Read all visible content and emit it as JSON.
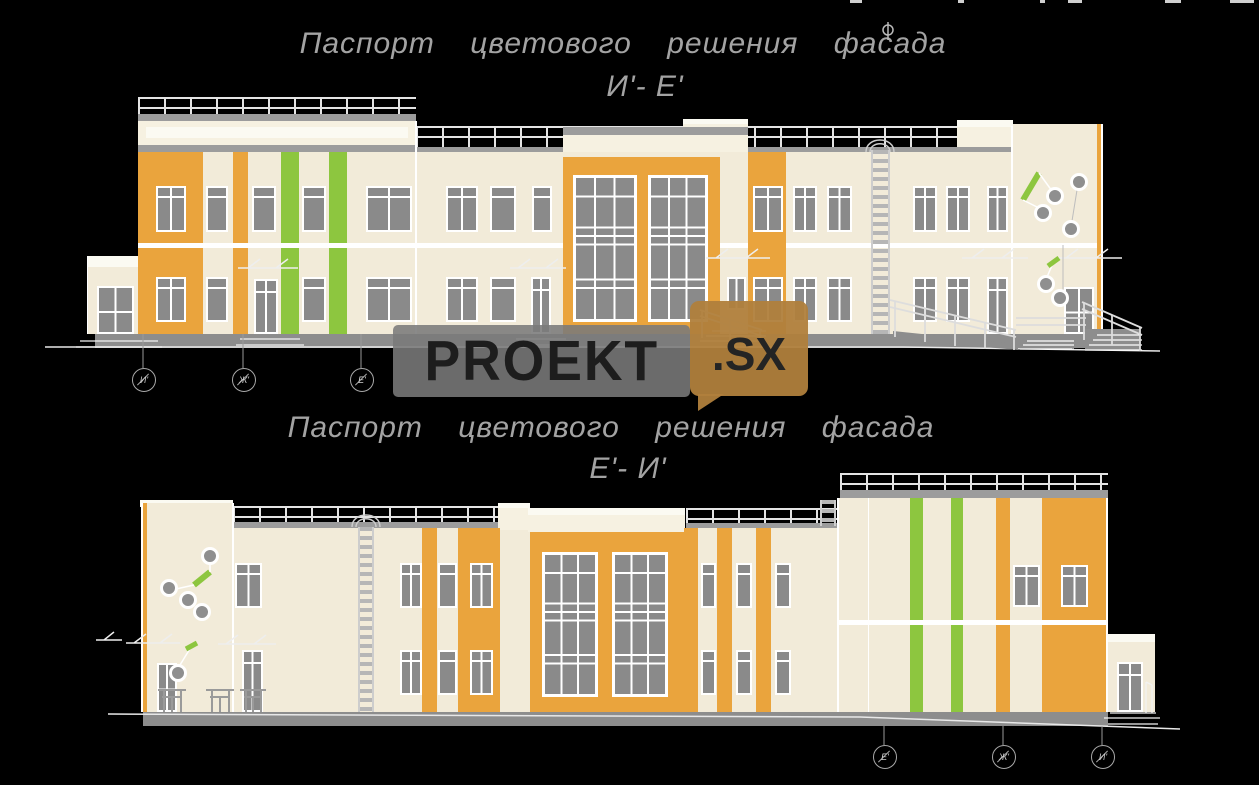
{
  "titles": {
    "facade_top": {
      "line1": "Паспорт цветового решения фасада",
      "line2": "И'- Е'"
    },
    "facade_bottom": {
      "line1": "Паспорт цветового решения фасада",
      "line2": "Е'- И'"
    }
  },
  "axis_markers": {
    "facade_top": [
      "И'",
      "Ж'",
      "Е'"
    ],
    "facade_bottom": [
      "Е'",
      "Ж'",
      "И'"
    ]
  },
  "watermark": {
    "brand": "PROEKT",
    "domain": ".SX"
  },
  "colors": {
    "background": "#000000",
    "wall_cream": "#f2ebd9",
    "accent_orange": "#eaa43d",
    "accent_green": "#8dc63f",
    "window_gray": "#8a8a8a",
    "plinth_gray": "#8d8d8d",
    "title_gray": "#a3a3a3"
  }
}
